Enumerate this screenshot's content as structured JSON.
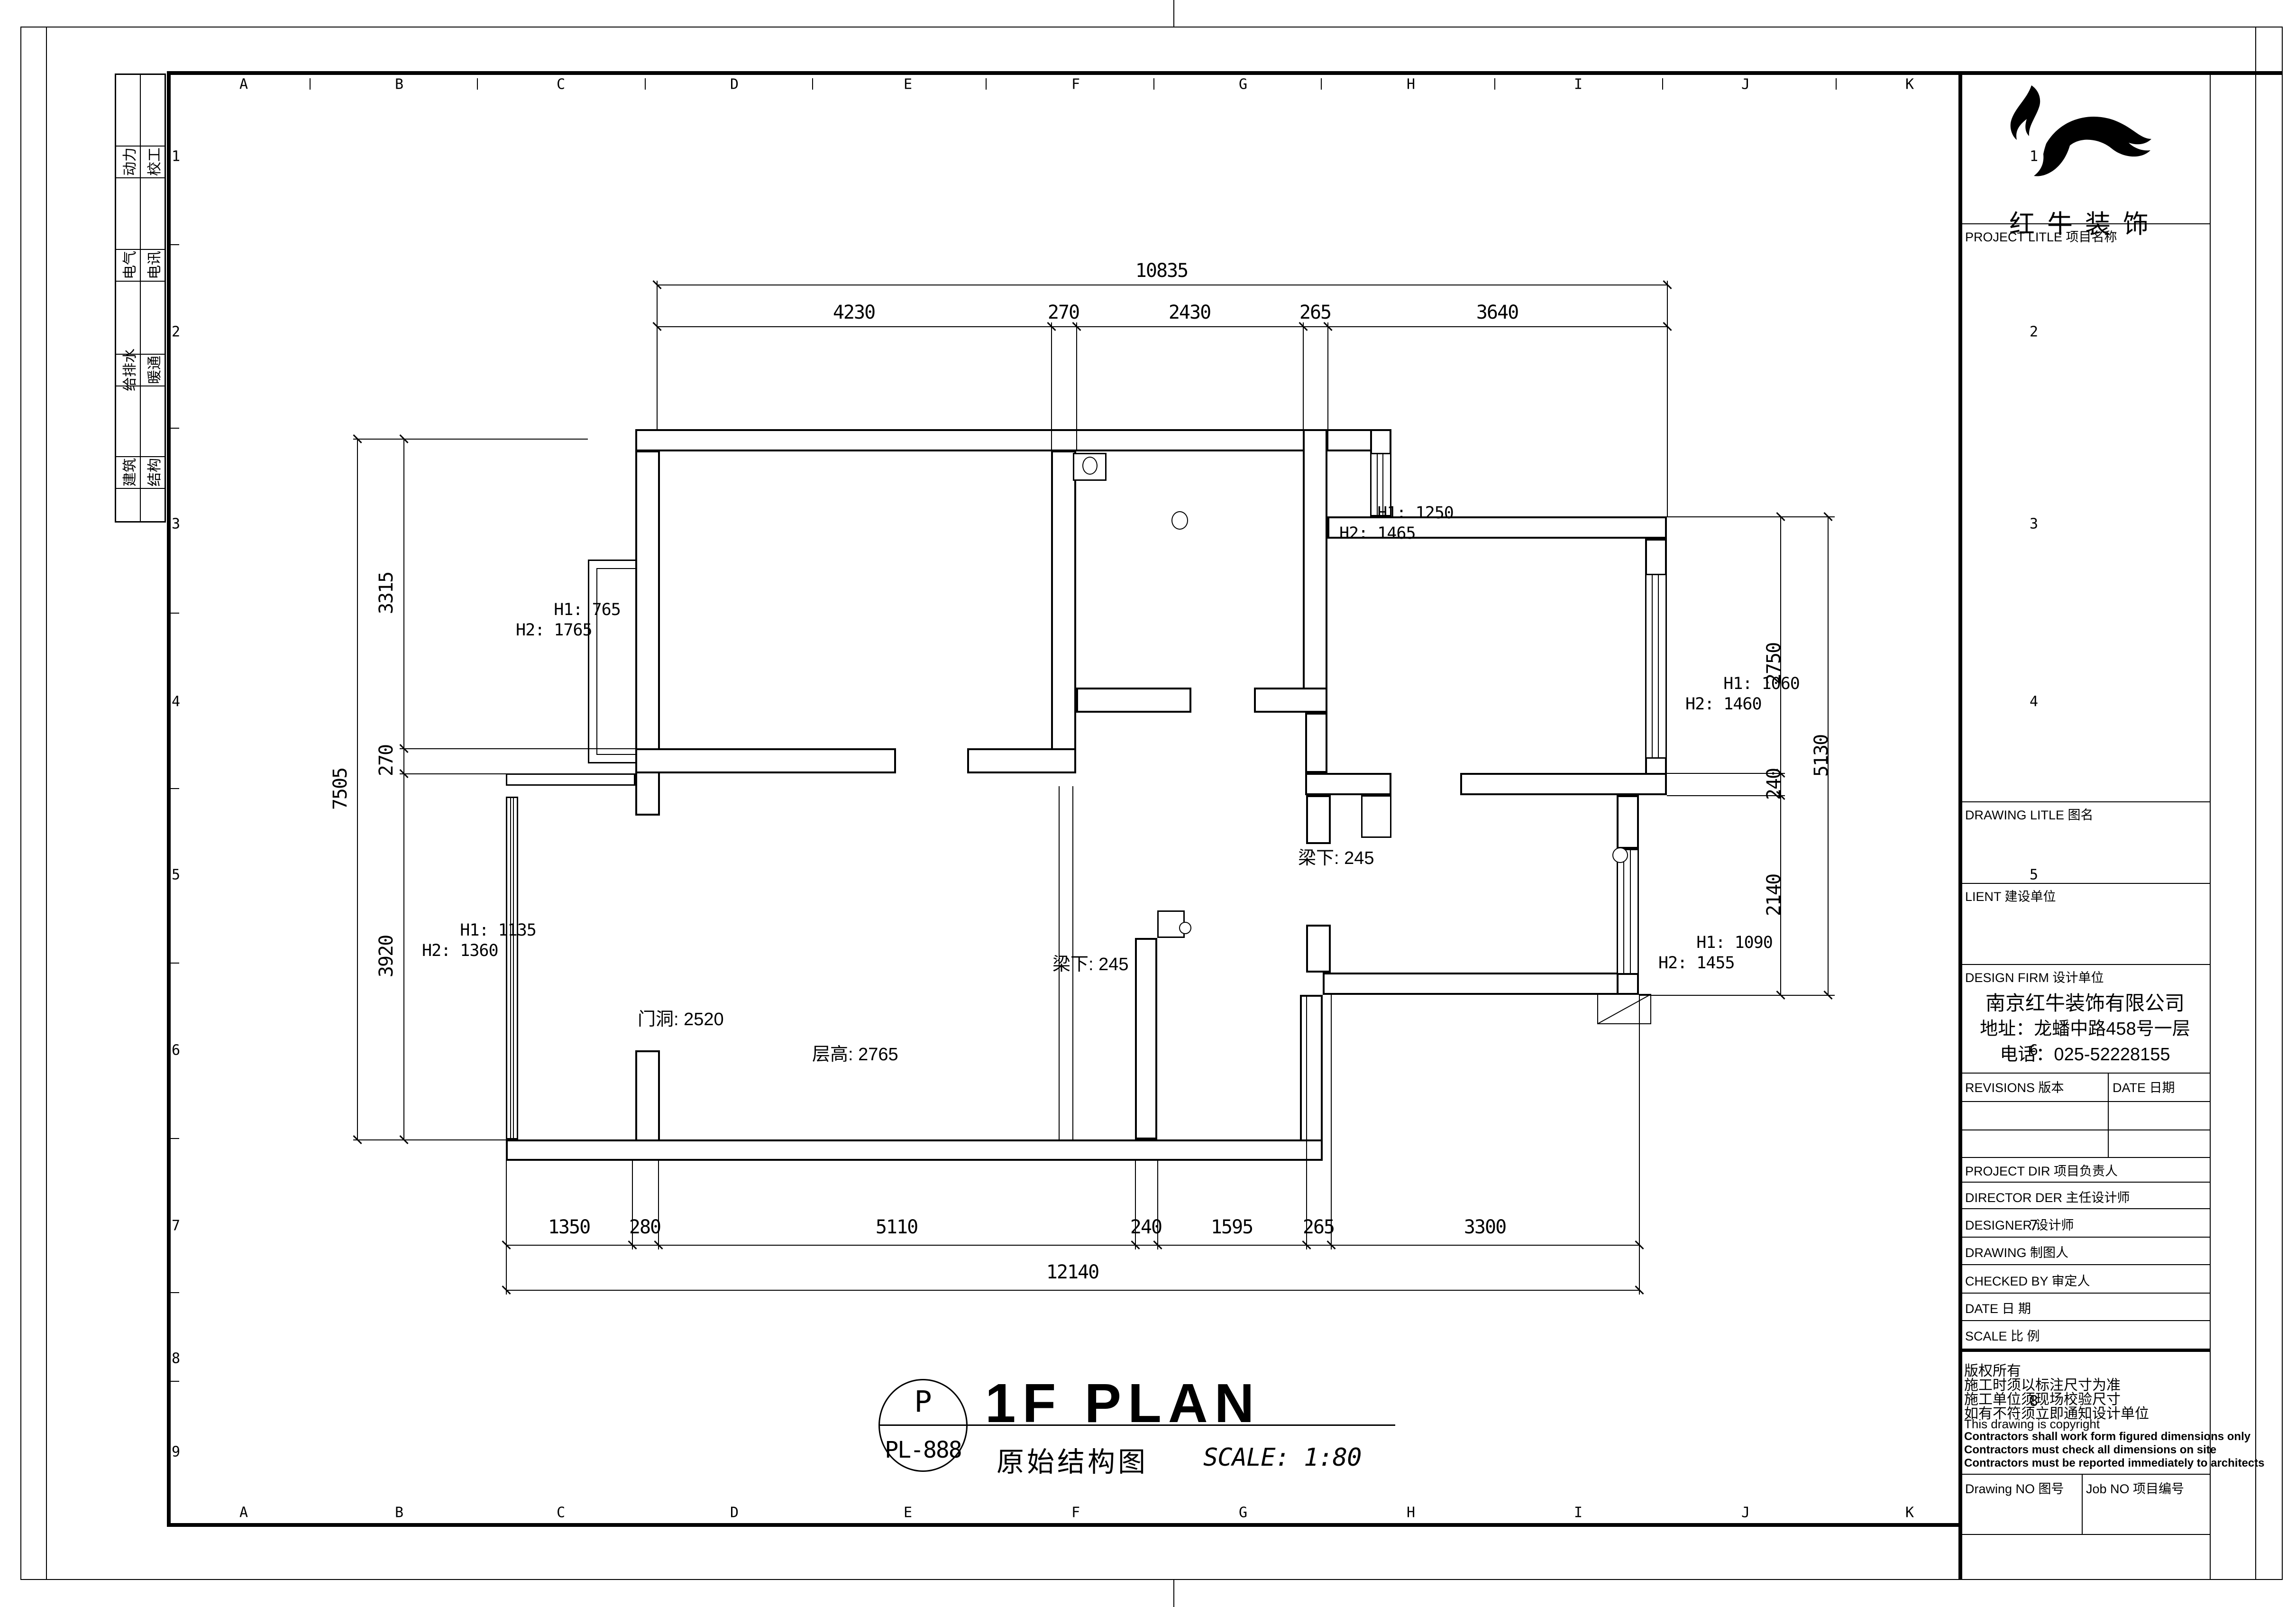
{
  "grid": {
    "letters": [
      "A",
      "B",
      "C",
      "D",
      "E",
      "F",
      "G",
      "H",
      "I",
      "J",
      "K"
    ],
    "left_numbers": [
      "1",
      "2",
      "3",
      "4",
      "5",
      "6",
      "7",
      "8",
      "9"
    ],
    "right_numbers": [
      "1",
      "2",
      "3",
      "4",
      "5",
      "6",
      "7",
      "8"
    ]
  },
  "sidebar": {
    "rows": [
      {
        "a": "动力",
        "b": "校工"
      },
      {
        "a": "电气",
        "b": "电讯"
      },
      {
        "a": "给排水",
        "b": "暖通"
      },
      {
        "a": "建筑",
        "b": "结构"
      }
    ]
  },
  "dims": {
    "top": {
      "total": "10835",
      "segs": [
        "4230",
        "270",
        "2430",
        "265",
        "3640"
      ]
    },
    "bottom": {
      "total": "12140",
      "segs": [
        "1350",
        "280",
        "5110",
        "240",
        "1595",
        "265",
        "3300"
      ]
    },
    "left": {
      "total": "7505",
      "segs": [
        "3315",
        "270",
        "3920"
      ]
    },
    "right": {
      "outer": "5130",
      "segs": [
        "2750",
        "240",
        "2140"
      ]
    }
  },
  "plan": {
    "windows": [
      {
        "h1": "H1: 765",
        "h2": "H2: 1765"
      },
      {
        "h1": "H1: 1250",
        "h2": "H2: 1465"
      },
      {
        "h1": "H1: 1060",
        "h2": "H2: 1460"
      },
      {
        "h1": "H1: 1090",
        "h2": "H2: 1455"
      },
      {
        "h1": "H1: 1135",
        "h2": "H2: 1360"
      }
    ],
    "notes": {
      "door": "门洞: 2520",
      "height": "层高: 2765",
      "beam1": "梁下: 245",
      "beam2": "梁下: 245"
    }
  },
  "title": {
    "name": "1F PLAN",
    "cn": "原始结构图",
    "scale": "SCALE: 1:80",
    "bubble_letter": "P",
    "bubble_code": "PL-888"
  },
  "titleblock": {
    "brand": "红牛装饰",
    "project": "PROJECT LITLE  项目名称",
    "drawing": "DRAWING LITLE  图名",
    "client": "LIENT  建设单位",
    "firm": "DESIGN FIRM  设计单位",
    "company": "南京红牛装饰有限公司",
    "address": "地址：龙蟠中路458号一层",
    "phone": "电话：025-52228155",
    "revisions": "REVISIONS  版本",
    "date_hdr": "DATE  日期",
    "rows": [
      "PROJECT DIR      项目负责人",
      "DIRECTOR DER 主任设计师",
      "DESIGNER         设计师",
      "DRAWING          制图人",
      "CHECKED BY     审定人",
      "DATE                 日    期",
      "SCALE               比    例"
    ],
    "notes": [
      "版权所有",
      "施工时须以标注尺寸为准",
      "施工单位须现场校验尺寸",
      "如有不符须立即通知设计单位",
      "This drawing is copyright",
      "Contractors shall work form figured dimensions only",
      "Contractors must check all dimensions on site",
      "Contractors must be reported immediately to architects"
    ],
    "drawing_no": "Drawing NO  图号",
    "job_no": "Job NO  项目编号"
  }
}
